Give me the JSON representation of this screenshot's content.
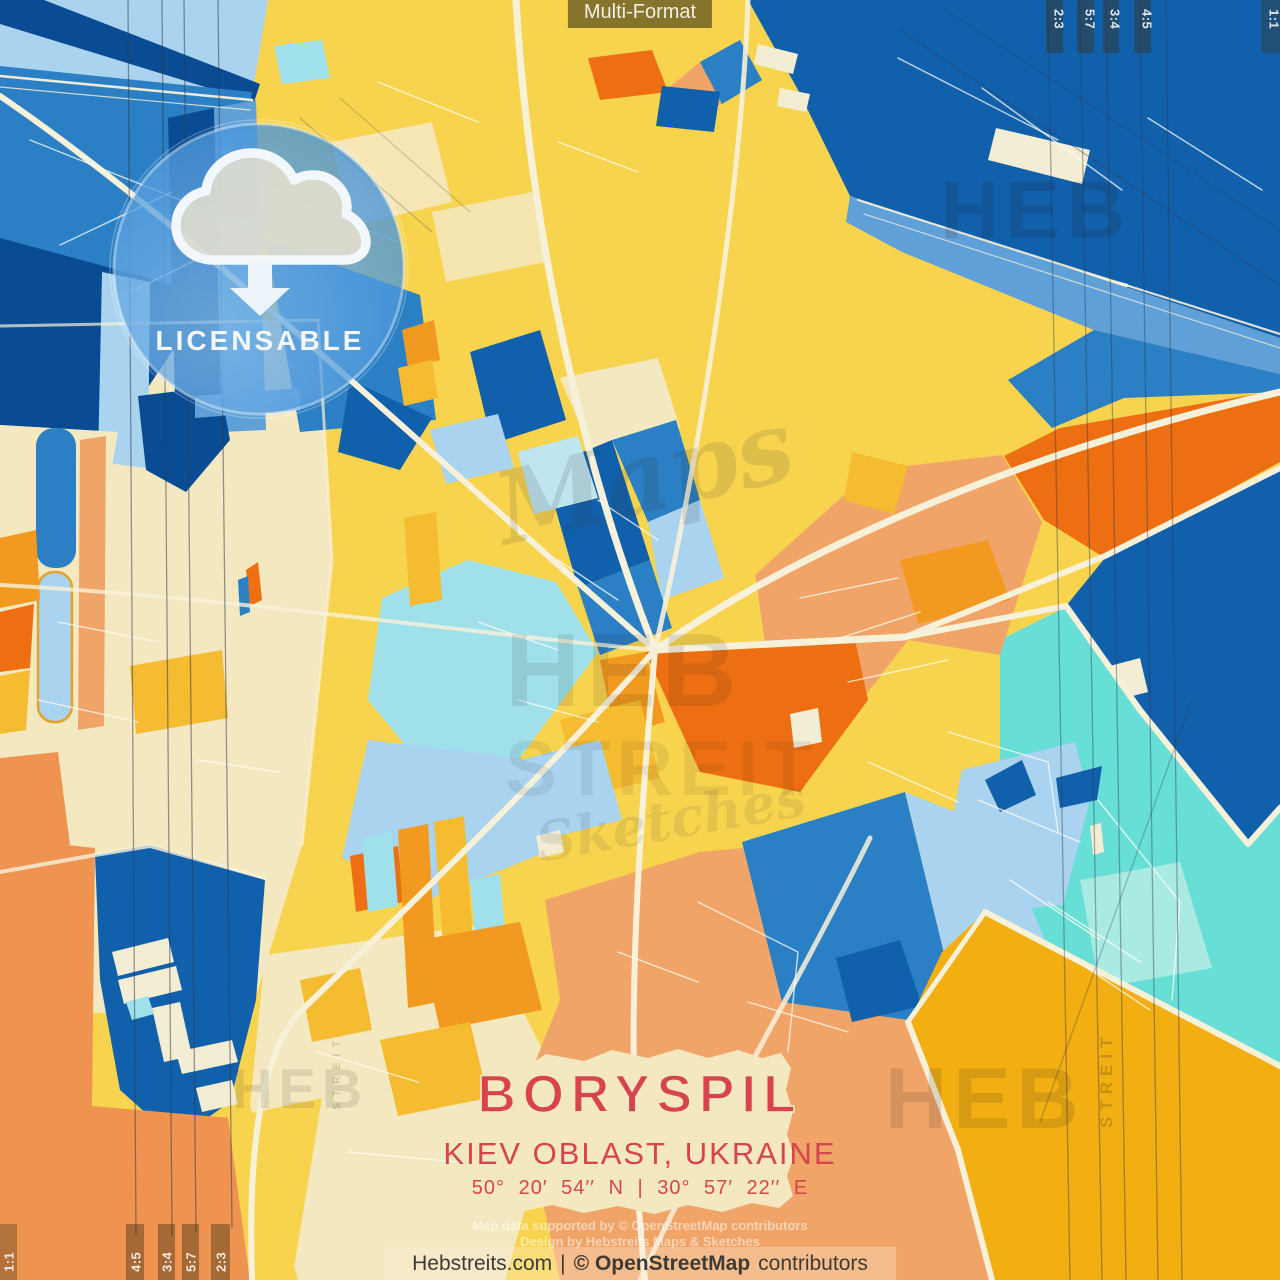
{
  "poster": {
    "format_badge": "Multi-Format",
    "license_badge": "LICENSABLE",
    "aspect_marks_top_right": [
      "2:3",
      "5:7",
      "3:4",
      "4:5",
      "1:1"
    ],
    "aspect_marks_bottom_left": [
      "1:1",
      "4:5",
      "3:4",
      "5:7",
      "2:3"
    ]
  },
  "title_card": {
    "city": "BORYSPIL",
    "region": "KIEV OBLAST, UKRAINE",
    "coordinates": "50° 20′ 54′′ N | 30° 57′ 22′′ E"
  },
  "credits": {
    "map_data": "Map data supported by © OpenStreetMap contributors",
    "design": "Design by Hebstreits Maps & Sketches",
    "footer": {
      "site": "Hebstreits.com",
      "divider": "|",
      "osm": "© OpenStreetMap",
      "suffix": "contributors"
    }
  },
  "watermarks": {
    "heb": "HEB",
    "streit": "STREIT",
    "script_word_1": "Maps",
    "script_word_2": "Sketches"
  },
  "palette": {
    "yellow": "#F8D44E",
    "amber": "#F5BB31",
    "gold": "#F3AE12",
    "cream_field": "#F4E8C0",
    "cream_road": "#F8F1D9",
    "cream_bldg": "#F3EDD3",
    "blue_light": "#A9D3EF",
    "blue_sky": "#5FA0D8",
    "blue_mid": "#2B7FC4",
    "blue_dark": "#1160AC",
    "blue_deep": "#0A4C93",
    "cyan_pale": "#BFE5F0",
    "cyan_soft": "#9FE0EA",
    "teal": "#67DED6",
    "teal_pale": "#A9EBE3",
    "orange_deep": "#EE6F12",
    "orange_mid": "#F2991F",
    "salmon": "#F1A467",
    "orange_muted": "#EF9350",
    "red_title": "#D8444E",
    "badge_olive": "rgba(114,99,40,0.85)",
    "bar_tint": "rgba(62,48,18,0.42)",
    "white_soft": "#FFFDF4",
    "circle_blue": "#4493DC"
  }
}
